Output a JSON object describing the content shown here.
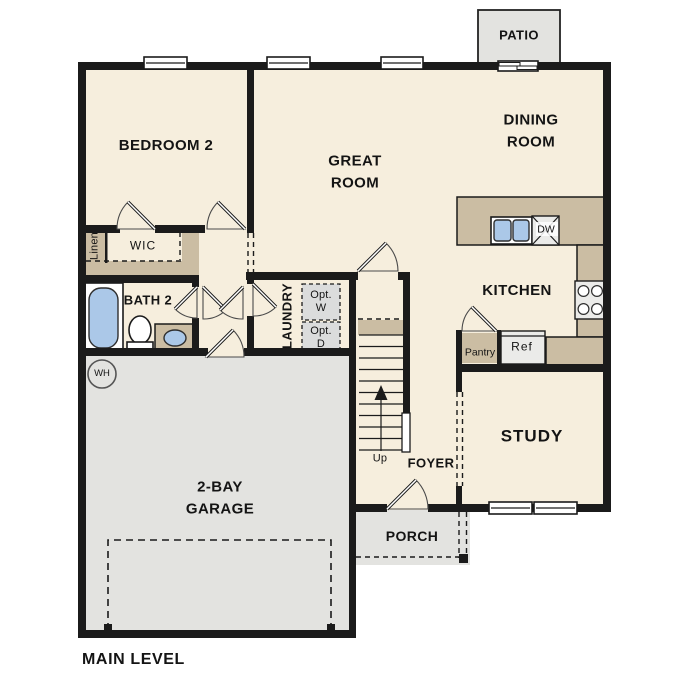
{
  "plan_title": "MAIN LEVEL",
  "labels": {
    "patio": "PATIO",
    "bedroom2": "BEDROOM 2",
    "great_room": "GREAT\nROOM",
    "dining_room": "DINING\nROOM",
    "kitchen": "KITCHEN",
    "wic": "WIC",
    "linen": "Linen",
    "bath2": "BATH 2",
    "laundry": "LAUNDRY",
    "opt_w": "Opt.\nW",
    "opt_d": "Opt.\nD",
    "pantry": "Pantry",
    "ref": "Ref",
    "dw": "DW",
    "study": "STUDY",
    "foyer": "FOYER",
    "porch": "PORCH",
    "garage": "2-BAY\nGARAGE",
    "up": "Up",
    "wh": "WH"
  },
  "colors": {
    "floor": "#f6eedd",
    "concrete": "#e3e3e0",
    "counter": "#cbbda3",
    "wall": "#1b1b1b",
    "fixture_blue": "#abc8e8",
    "appliance": "#ebebe9",
    "option_box": "#dbdcdc"
  }
}
